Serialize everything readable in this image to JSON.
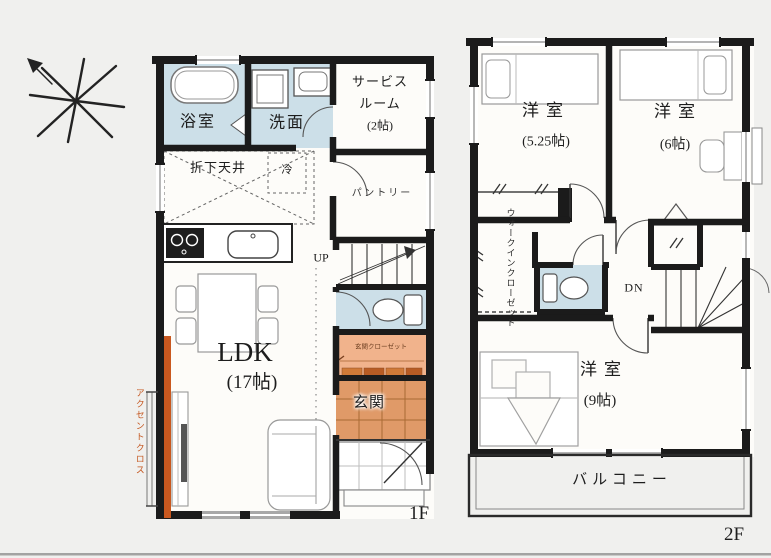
{
  "floor1": {
    "label": "1F",
    "rooms": {
      "bath": "浴室",
      "washroom": "洗面",
      "service1": "サービス",
      "service2": "ルーム",
      "service3": "(2帖)",
      "dropped_ceiling": "折下天井",
      "fridge": "冷",
      "pantry": "パントリー",
      "stairs_up": "UP",
      "ldk_name": "LDK",
      "ldk_size": "(17帖)",
      "entrance": "玄関",
      "entrance_closet": "玄関クローゼット",
      "accent_cloth": "アクセントクロス"
    }
  },
  "floor2": {
    "label": "2F",
    "rooms": {
      "bedroom1_name": "洋室",
      "bedroom1_size": "(5.25帖)",
      "bedroom2_name": "洋室",
      "bedroom2_size": "(6帖)",
      "wic_line1": "ウォークイン",
      "wic_line2": "クローゼット",
      "stairs_down": "DN",
      "bedroom3_name": "洋室",
      "bedroom3_size": "(9帖)",
      "balcony": "バルコニー"
    }
  },
  "colors": {
    "wall": "#1b1b1b",
    "water_room_blue": "#ccdfe8",
    "closet_salmon": "#f1b38c",
    "entrance_tile": "#e09a68",
    "accent_orange": "#c9581f"
  }
}
